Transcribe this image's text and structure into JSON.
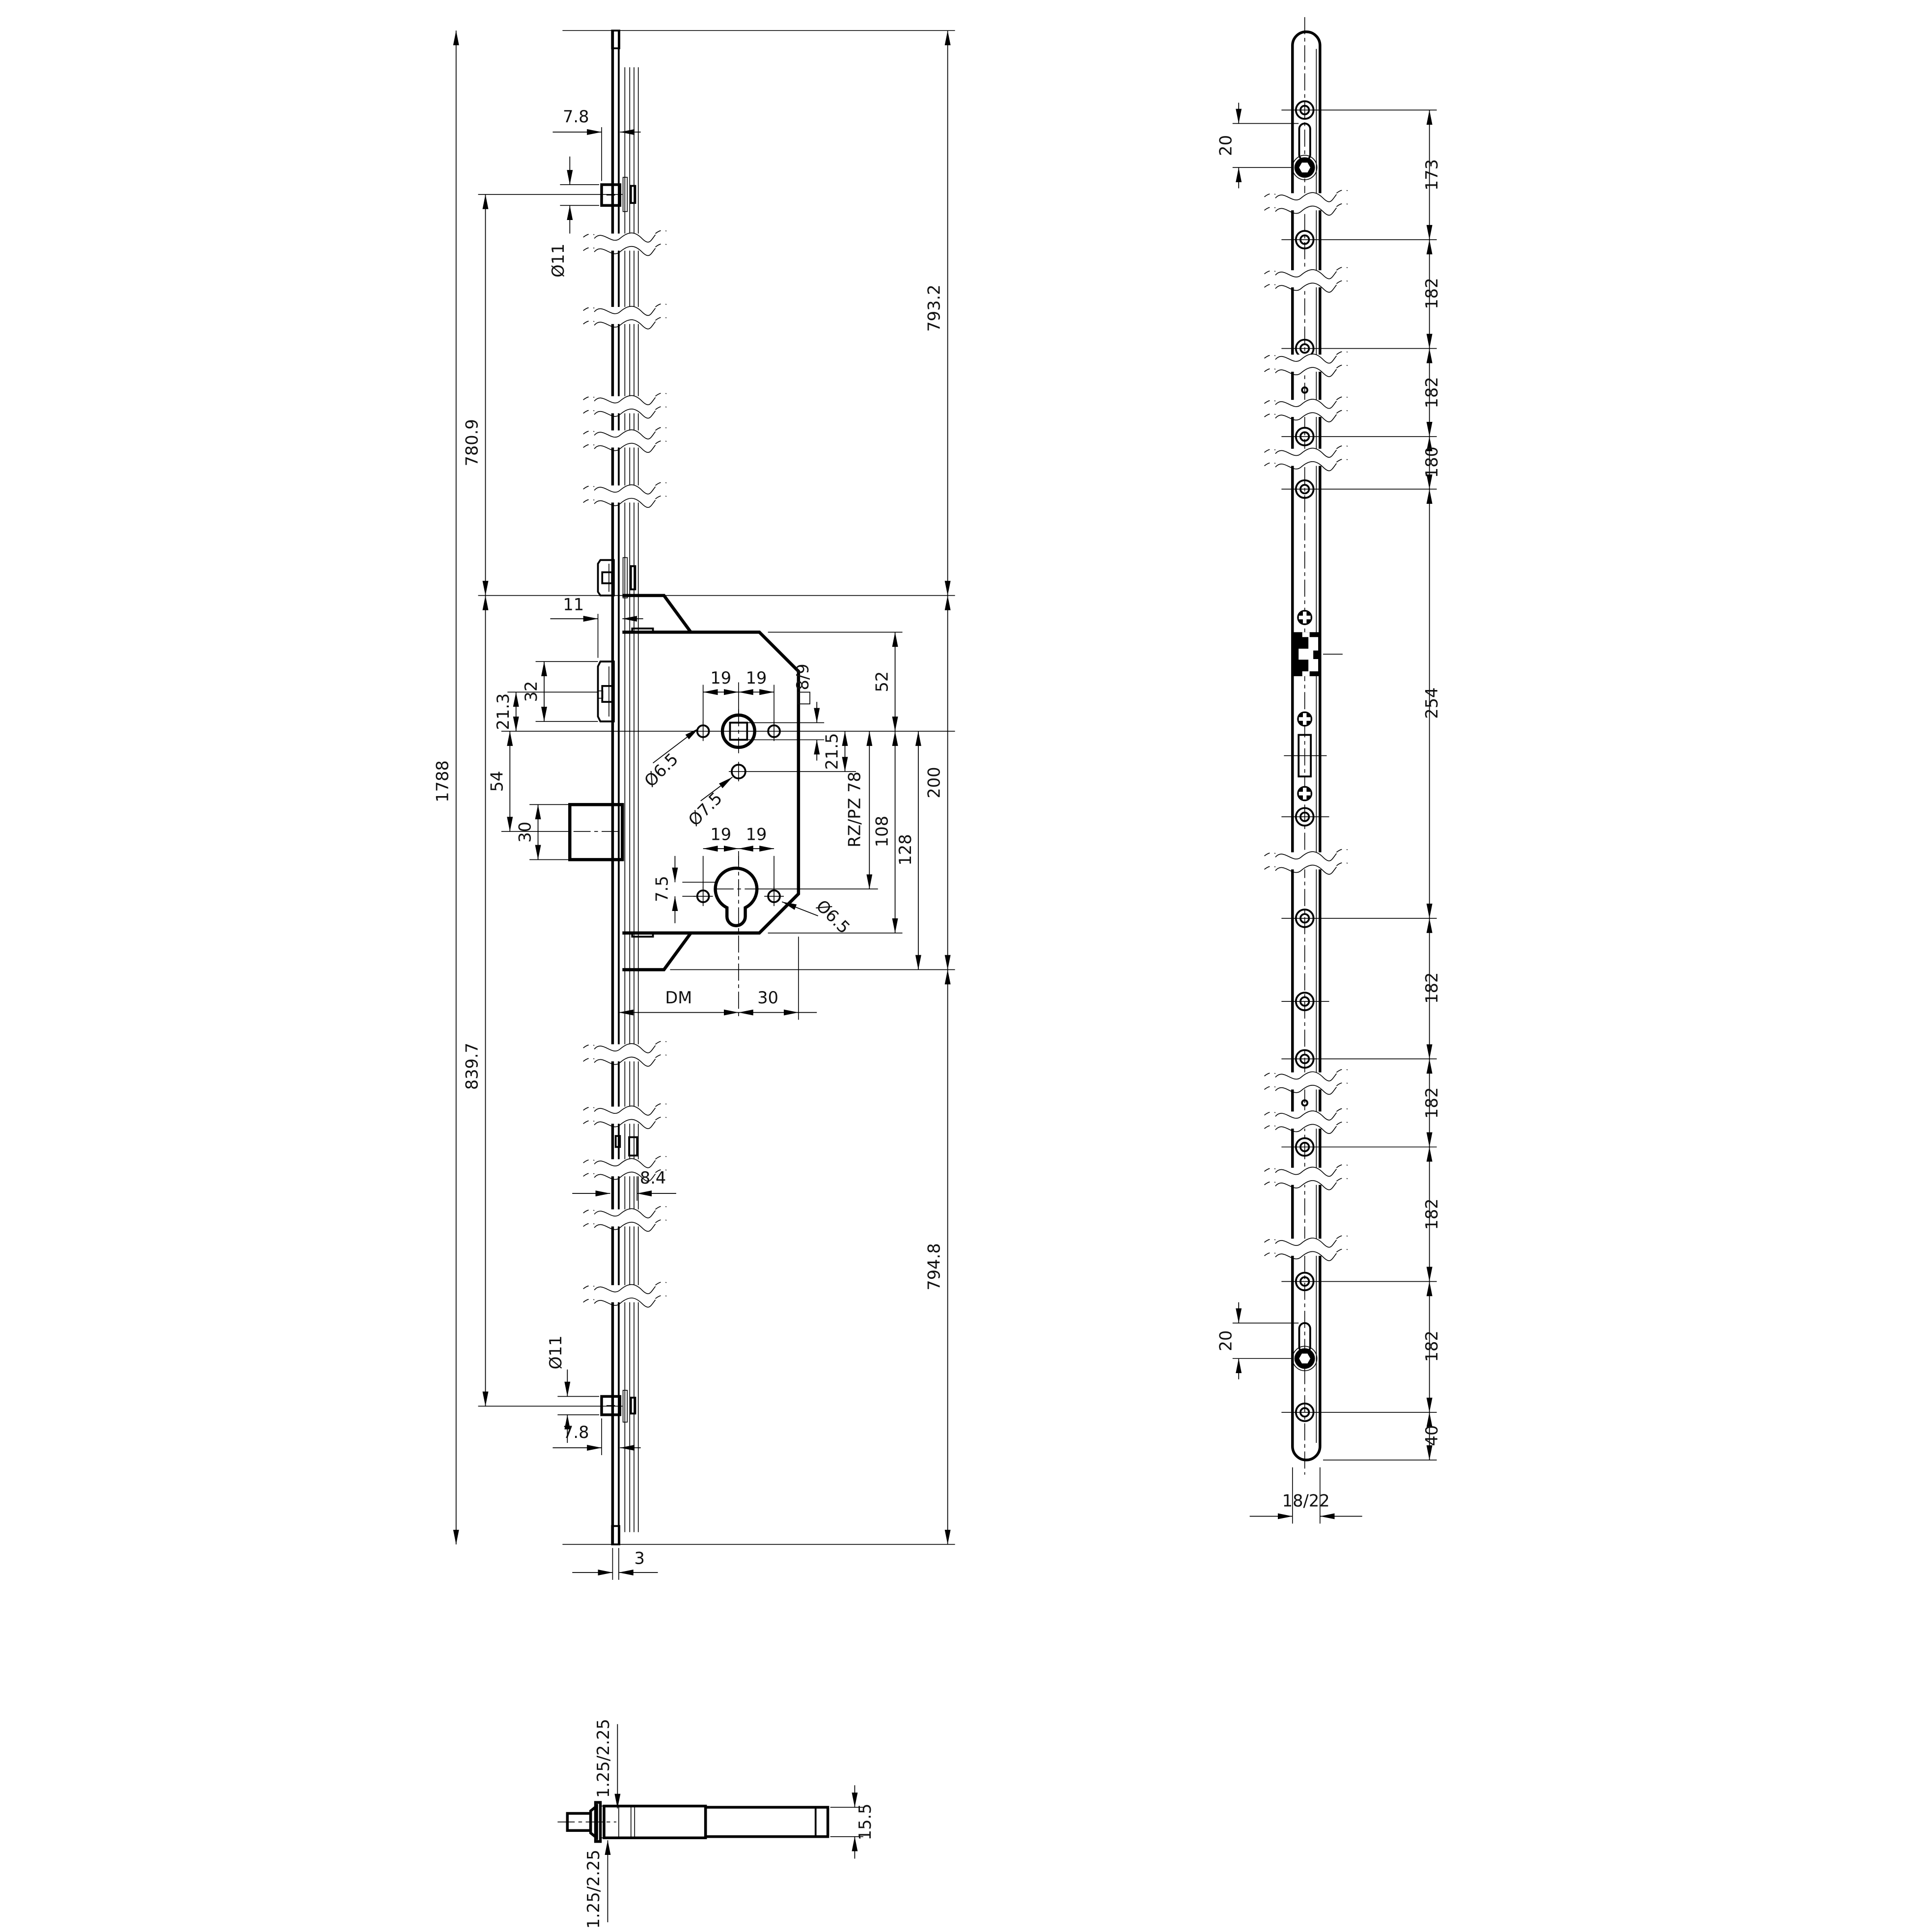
{
  "drawing_title": "Multipoint lock technical drawing",
  "side": {
    "overall": "1788",
    "upper_span": "780.9",
    "lower_span": "839.7",
    "right_upper": "793.2",
    "cutout": "200",
    "right_lower": "794.8",
    "top_pin_dia": "Ø11",
    "top_pin_offset": "7.8",
    "bottom_pin_dia": "Ø11",
    "bottom_pin_offset": "7.8",
    "plate_thickness": "3",
    "channel_depth": "8.4",
    "latch_protrusion": "11",
    "latch_height": "32",
    "latch_offset": "21.3",
    "follower_to_bolt": "54",
    "bolt_height": "30",
    "spacing": [
      "19",
      "19",
      "19",
      "19"
    ],
    "square": "□8/9",
    "hole_top": "Ø6.5",
    "hole_mid": "Ø7.5",
    "hole_bottom": "Ø6.5",
    "offset_215": "21.5",
    "cyl_distance": "RZ/PZ 78",
    "case_lower": "108",
    "below_case": "128",
    "hole_offset": "7.5",
    "backset": "DM",
    "backset_right": "30"
  },
  "front": {
    "chain": [
      "173",
      "182",
      "182",
      "180",
      "254",
      "182",
      "182",
      "182",
      "182",
      "40"
    ],
    "slot_top": "20",
    "slot_bottom": "20",
    "width": "18/22"
  },
  "section": {
    "t_top": "1.25/2.25",
    "t_bottom": "1.25/2.25",
    "height": "15.5"
  }
}
